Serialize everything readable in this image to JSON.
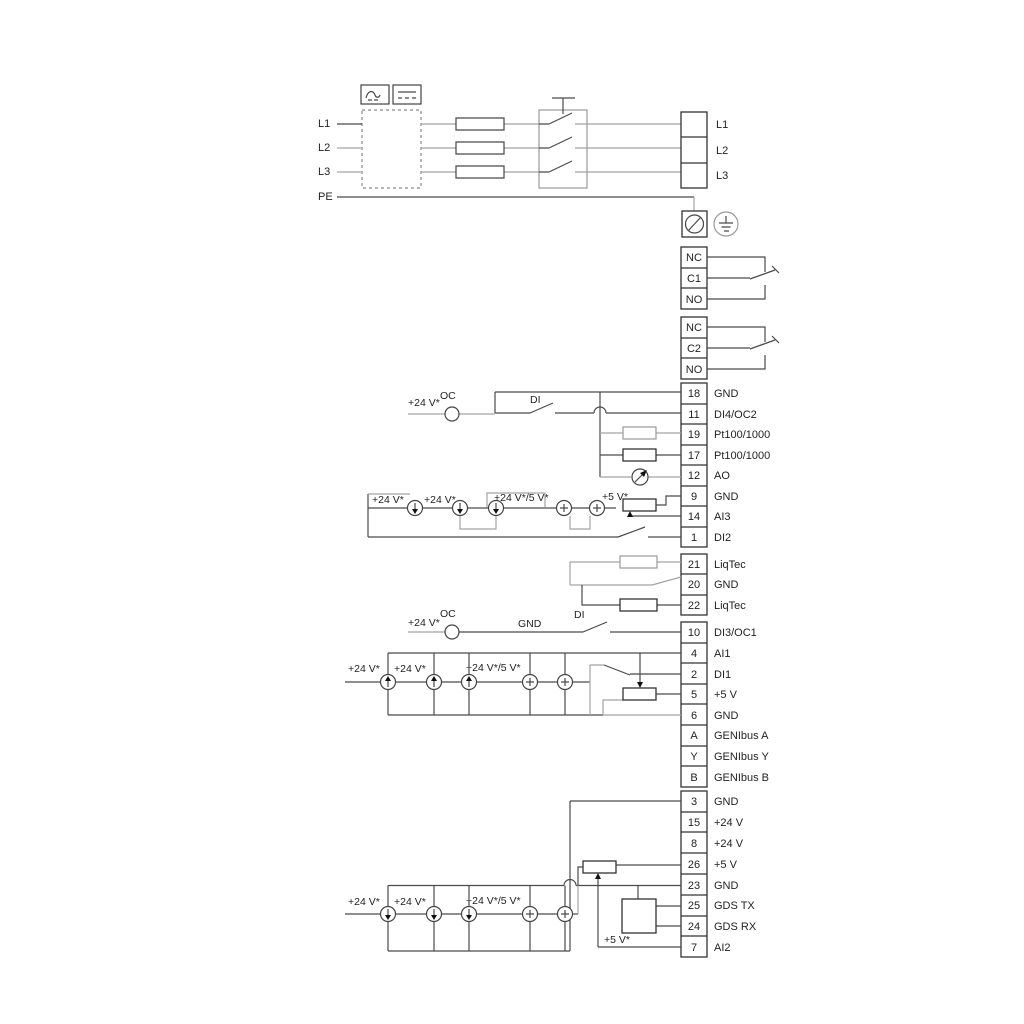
{
  "mains_in": {
    "l1": "L1",
    "l2": "L2",
    "l3": "L3",
    "pe": "PE"
  },
  "mains_out": {
    "l1": "L1",
    "l2": "L2",
    "l3": "L3"
  },
  "relay1": {
    "nc": "NC",
    "c": "C1",
    "no": "NO"
  },
  "relay2": {
    "nc": "NC",
    "c": "C2",
    "no": "NO"
  },
  "annotations": {
    "v24": "+24 V*",
    "v24_5": "+24 V*/5 V*",
    "v5": "+5 V*",
    "oc": "OC",
    "di": "DI",
    "gnd": "GND"
  },
  "io_group1": {
    "rows": [
      {
        "no": "18",
        "label": "GND"
      },
      {
        "no": "11",
        "label": "DI4/OC2"
      },
      {
        "no": "19",
        "label": "Pt100/1000"
      },
      {
        "no": "17",
        "label": "Pt100/1000"
      },
      {
        "no": "12",
        "label": "AO"
      },
      {
        "no": "9",
        "label": "GND"
      },
      {
        "no": "14",
        "label": "AI3"
      },
      {
        "no": "1",
        "label": "DI2"
      }
    ]
  },
  "liqtec": {
    "rows": [
      {
        "no": "21",
        "label": "LiqTec"
      },
      {
        "no": "20",
        "label": "GND"
      },
      {
        "no": "22",
        "label": "LiqTec"
      }
    ]
  },
  "io_group2": {
    "rows": [
      {
        "no": "10",
        "label": "DI3/OC1"
      },
      {
        "no": "4",
        "label": "AI1"
      },
      {
        "no": "2",
        "label": "DI1"
      },
      {
        "no": "5",
        "label": "+5 V"
      },
      {
        "no": "6",
        "label": "GND"
      },
      {
        "no": "A",
        "label": "GENIbus A"
      },
      {
        "no": "Y",
        "label": "GENIbus Y"
      },
      {
        "no": "B",
        "label": "GENIbus B"
      }
    ]
  },
  "io_group3": {
    "rows": [
      {
        "no": "3",
        "label": "GND"
      },
      {
        "no": "15",
        "label": "+24 V"
      },
      {
        "no": "8",
        "label": "+24 V"
      },
      {
        "no": "26",
        "label": "+5 V"
      },
      {
        "no": "23",
        "label": "GND"
      },
      {
        "no": "25",
        "label": "GDS TX"
      },
      {
        "no": "24",
        "label": "GDS RX"
      },
      {
        "no": "7",
        "label": "AI2"
      }
    ]
  }
}
